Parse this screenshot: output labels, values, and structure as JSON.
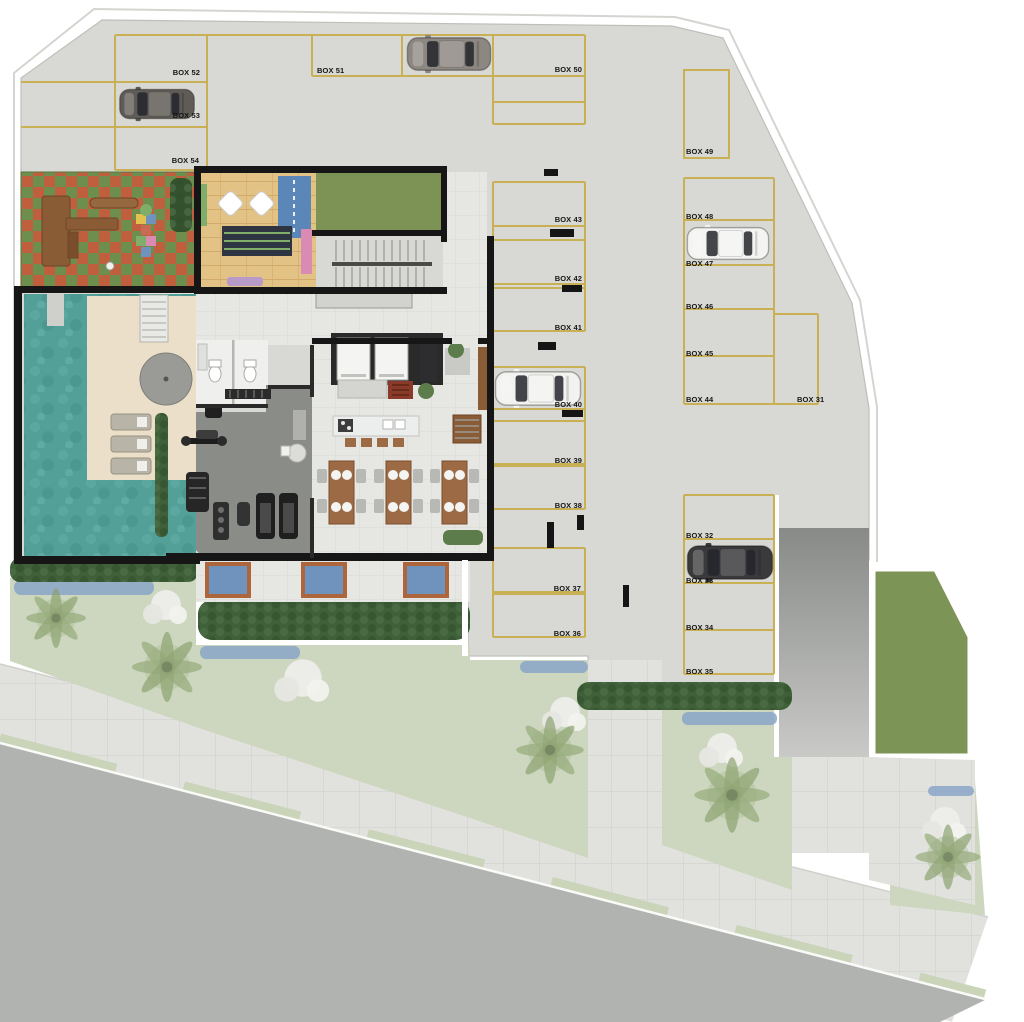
{
  "title": "Ground floor site plan with parking garage",
  "parking": {
    "boxes": [
      {
        "id": 52,
        "label": "BOX 52"
      },
      {
        "id": 53,
        "label": "BOX 53"
      },
      {
        "id": 54,
        "label": "BOX 54"
      },
      {
        "id": 51,
        "label": "BOX 51"
      },
      {
        "id": 50,
        "label": "BOX 50"
      },
      {
        "id": 49,
        "label": "BOX 49"
      },
      {
        "id": 48,
        "label": "BOX 48"
      },
      {
        "id": 47,
        "label": "BOX 47"
      },
      {
        "id": 46,
        "label": "BOX 46"
      },
      {
        "id": 45,
        "label": "BOX 45"
      },
      {
        "id": 44,
        "label": "BOX 44"
      },
      {
        "id": 31,
        "label": "BOX 31"
      },
      {
        "id": 43,
        "label": "BOX 43"
      },
      {
        "id": 42,
        "label": "BOX 42"
      },
      {
        "id": 41,
        "label": "BOX 41"
      },
      {
        "id": 40,
        "label": "BOX 40"
      },
      {
        "id": 39,
        "label": "BOX 39"
      },
      {
        "id": 38,
        "label": "BOX 38"
      },
      {
        "id": 37,
        "label": "BOX 37"
      },
      {
        "id": 36,
        "label": "BOX 36"
      },
      {
        "id": 32,
        "label": "BOX 32"
      },
      {
        "id": 33,
        "label": "BOX 33"
      },
      {
        "id": 34,
        "label": "BOX 34"
      },
      {
        "id": 35,
        "label": "BOX 35"
      }
    ]
  },
  "cars": [
    {
      "name": "car-top-row",
      "color": "#8d8781"
    },
    {
      "name": "car-box-53",
      "color": "#5f5b56"
    },
    {
      "name": "car-box-47",
      "color": "#f4f4f2"
    },
    {
      "name": "car-box-40",
      "color": "#f2f2f0"
    },
    {
      "name": "car-box-33",
      "color": "#3a3a3c"
    }
  ],
  "areas": [
    "parking-garage",
    "playground",
    "kids-room",
    "stair-hall",
    "elevators",
    "restrooms",
    "gym",
    "party-room",
    "kitchen-island",
    "dining-tables",
    "pool",
    "pool-deck",
    "garden-lawn",
    "hedges",
    "flower-beds",
    "car-ramp",
    "sidewalk",
    "street",
    "grass-yard"
  ],
  "colors": {
    "garage_floor": "#d8d9d4",
    "stall_line": "#c9b054",
    "wall": "#161616",
    "grass": "#7c9355",
    "lawn": "#cdd7bf",
    "pool_water": "#53a098",
    "deck": "#ecdfc9",
    "wood_floor": "#e3c285",
    "playground_green": "#6e8e4e",
    "playground_red": "#bf5f3d",
    "gym_floor": "#8a8c88",
    "party_floor": "#e5e5e1",
    "hedge": "#3f6038",
    "flowers_blue": "#8aa6c8",
    "flowers_white": "#ededea",
    "planter_rim": "#ad653c",
    "sidewalk": "#e1e2de",
    "street": "#b1b3b1",
    "ramp_top": "#8b8d8b",
    "ramp_bottom": "#c9cac7"
  }
}
